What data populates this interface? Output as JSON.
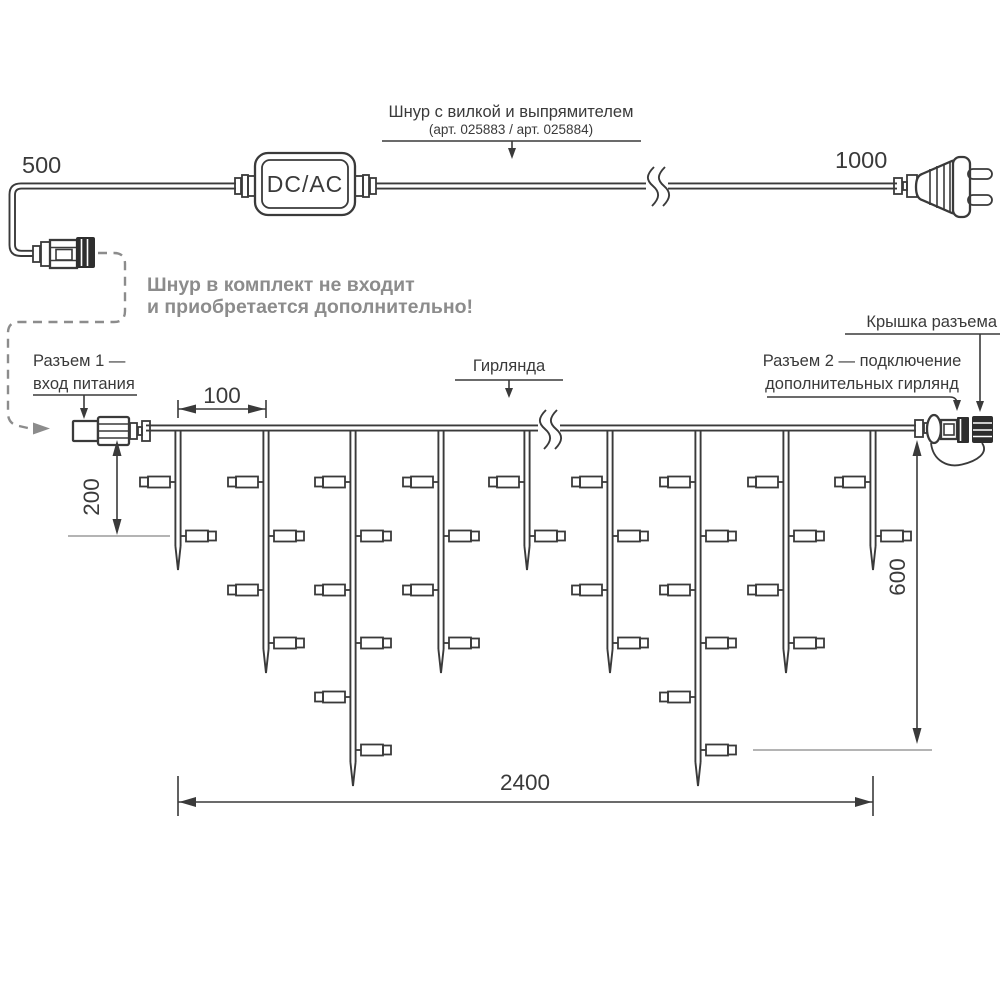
{
  "colors": {
    "line": "#3a3a3a",
    "muted": "#8c8c8c",
    "ref_line": "#9c9c9c",
    "cap_fill": "#2e2e2e",
    "background": "#ffffff"
  },
  "power_cord": {
    "dim_left": "500",
    "dim_right": "1000",
    "converter_label": "DC/AC",
    "callout_title": "Шнур с вилкой и выпрямителем",
    "callout_subtitle": "(арт. 025883 / арт. 025884)",
    "note_line1": "Шнур в комплект не входит",
    "note_line2": "и приобретается дополнительно!"
  },
  "garland": {
    "callout_garland": "Гирлянда",
    "callout_connector1_line1": "Разъем 1 —",
    "callout_connector1_line2": "вход питания",
    "callout_connector2_line1": "Разъем 2 — подключение",
    "callout_connector2_line2": "дополнительных гирлянд",
    "callout_cap": "Крышка разъема",
    "dim_drop_spacing": "100",
    "dim_short_drop": "200",
    "dim_long_drop": "600",
    "dim_total_length": "2400",
    "drops": {
      "xs": [
        178,
        266,
        353,
        441,
        527,
        610,
        698,
        786,
        873
      ],
      "lamp_counts": [
        2,
        4,
        6,
        4,
        2,
        4,
        6,
        4,
        2
      ],
      "lamp_row_ys": [
        482,
        536,
        590,
        643,
        697,
        750
      ],
      "tip_y_by_count": {
        "2": 570,
        "4": 673,
        "6": 786
      },
      "first_lamp_side": "left",
      "wire_y": 428
    }
  }
}
